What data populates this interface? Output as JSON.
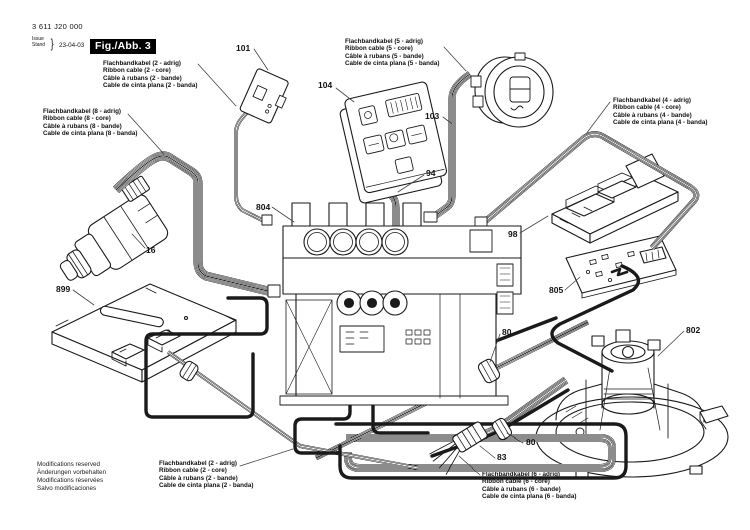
{
  "header": {
    "part_number": "3 611 J20 000",
    "issue_label": "Issue",
    "stand_label": "Stand",
    "brace": "}",
    "date": "23-04-03",
    "figure_label": "Fig./Abb. 3"
  },
  "colors": {
    "line": "#1a1a1a",
    "background": "#ffffff",
    "figure_box_bg": "#000000",
    "figure_box_text": "#ffffff"
  },
  "cable_labels": {
    "c2_top": {
      "l1": "Flachbandkabel (2 - adrig)",
      "l2": "Ribbon cable (2 - core)",
      "l3": "Câble à rubans (2 - bande)",
      "l4": "Cable de cinta plana (2 - banda)"
    },
    "c5": {
      "l1": "Flachbandkabel (5 - adrig)",
      "l2": "Ribbon cable (5 - core)",
      "l3": "Câble à rubans (5 - bande)",
      "l4": "Cable de cinta plana (5 - banda)"
    },
    "c8": {
      "l1": "Flachbandkabel (8 - adrig)",
      "l2": "Ribbon cable (8 - core)",
      "l3": "Câble à rubans (8 - bande)",
      "l4": "Cable de cinta plana (8 - banda)"
    },
    "c4": {
      "l1": "Flachbandkabel (4 - adrig)",
      "l2": "Ribbon cable (4 - core)",
      "l3": "Câble à rubans (4 - bande)",
      "l4": "Cable de cinta plana (4 - banda)"
    },
    "c2_bottom": {
      "l1": "Flachbandkabel (2 - adrig)",
      "l2": "Ribbon cable (2 - core)",
      "l3": "Câble à rubans (2 - bande)",
      "l4": "Cable de cinta plana (2 - banda)"
    },
    "c6": {
      "l1": "Flachbandkabel (6 - adrig)",
      "l2": "Ribbon cable (6 - core)",
      "l3": "Câble à rubans (6 - bande)",
      "l4": "Cable de cinta plana (6 - banda)"
    }
  },
  "part_refs": {
    "p101": "101",
    "p104": "104",
    "p103": "103",
    "p94": "94",
    "p804": "804",
    "p16": "16",
    "p98": "98",
    "p899": "899",
    "p805": "805",
    "p80a": "80",
    "p802": "802",
    "p80b": "80",
    "p83": "83"
  },
  "footer": {
    "line1": "Modifications reserved",
    "line2": "Änderungen vorbehalten",
    "line3": "Modifications réservées",
    "line4": "Salvo modificaciones"
  }
}
